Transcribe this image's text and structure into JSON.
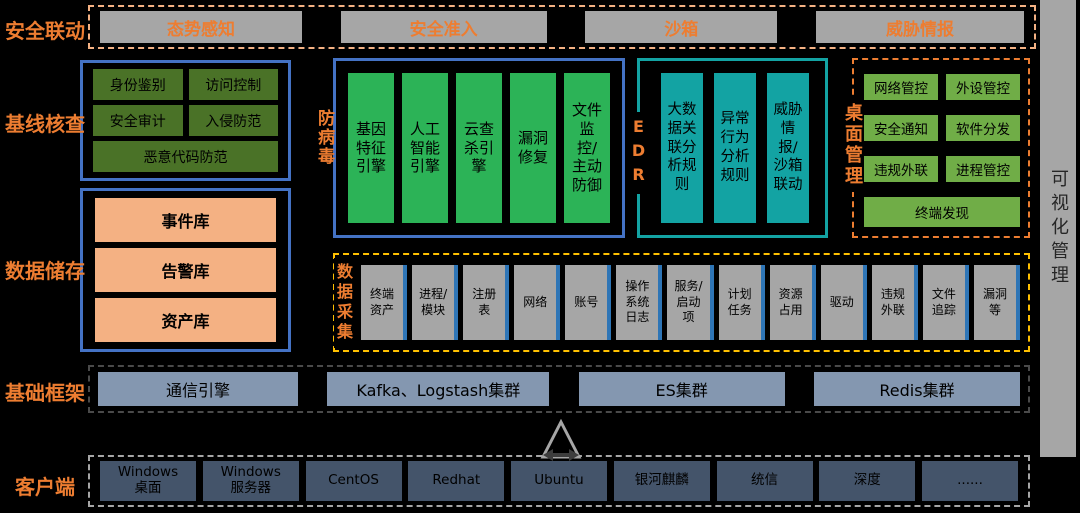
{
  "colors": {
    "background": "#000000",
    "accent_orange": "#ED7D31",
    "peach_border": "#F4B183",
    "blue_border": "#4472C4",
    "teal": "#13A3A3",
    "olive_green": "#4A7227",
    "bright_green": "#2CB357",
    "light_green": "#70AD47",
    "peach_fill": "#F4B183",
    "yellow_border": "#FFC000",
    "gray_fill": "#A6A6A6",
    "blue_strip": "#2E75B6",
    "blue_gray": "#8497B0",
    "dark_slate": "#44546A"
  },
  "sections": {
    "security_linkage": {
      "label": "安全联动",
      "items": [
        "态势感知",
        "安全准入",
        "沙箱",
        "威胁情报"
      ]
    },
    "baseline_check": {
      "label": "基线核查",
      "items": [
        "身份鉴别",
        "访问控制",
        "安全审计",
        "入侵防范",
        "恶意代码防范"
      ]
    },
    "antivirus": {
      "label": "防病毒",
      "items": [
        "基因特征引擎",
        "人工智能引擎",
        "云查杀引擎",
        "漏洞修复",
        "文件监控/主动防御"
      ]
    },
    "edr": {
      "label": "EDR",
      "items": [
        "大数据关联分析规则",
        "异常行为分析规则",
        "威胁情报/沙箱联动"
      ]
    },
    "desktop_management": {
      "label": "桌面管理",
      "items": [
        "网络管控",
        "外设管控",
        "安全通知",
        "软件分发",
        "违规外联",
        "进程管控",
        "终端发现"
      ]
    },
    "data_storage": {
      "label": "数据储存",
      "items": [
        "事件库",
        "告警库",
        "资产库"
      ]
    },
    "data_collection": {
      "label": "数据采集",
      "items": [
        "终端资产",
        "进程/模块",
        "注册表",
        "网络",
        "账号",
        "操作系统日志",
        "服务/启动项",
        "计划任务",
        "资源占用",
        "驱动",
        "违规外联",
        "文件追踪",
        "漏洞等"
      ]
    },
    "base_framework": {
      "label": "基础框架",
      "items": [
        "通信引擎",
        "Kafka、Logstash集群",
        "ES集群",
        "Redis集群"
      ]
    },
    "client": {
      "label": "客户端",
      "items": [
        "Windows桌面",
        "Windows服务器",
        "CentOS",
        "Redhat",
        "Ubuntu",
        "银河麒麟",
        "统信",
        "深度",
        "......"
      ]
    },
    "visualization": {
      "label": "可视化管理"
    }
  }
}
